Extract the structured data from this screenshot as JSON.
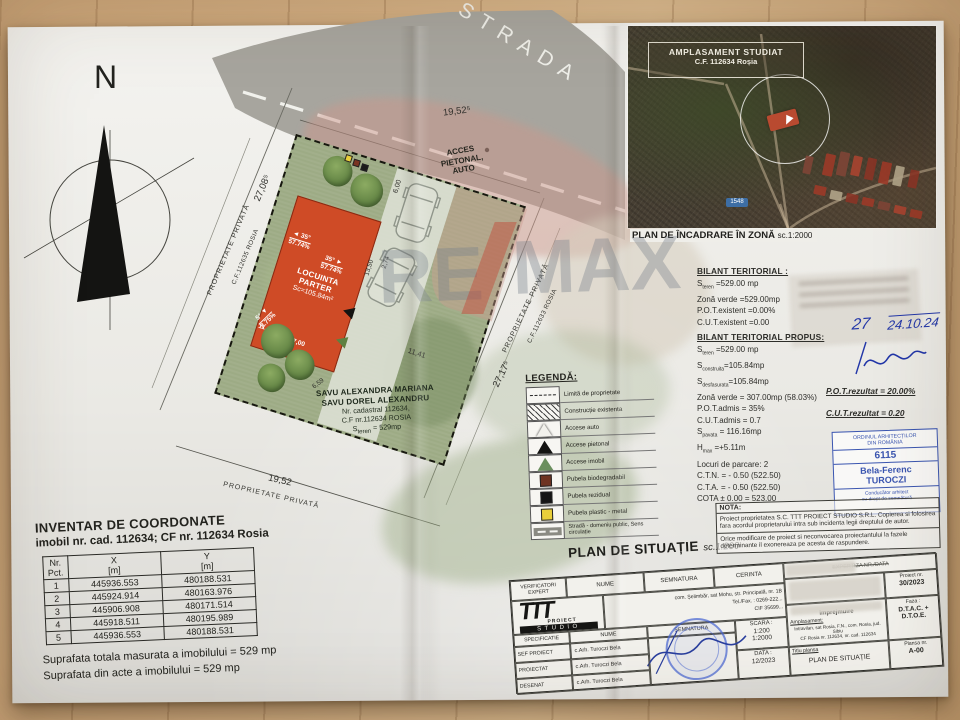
{
  "compass": {
    "label": "N"
  },
  "street": {
    "name": "STRADA",
    "dim": "19,52⁵",
    "access": [
      "ACCES",
      "PIETONAL,",
      "AUTO"
    ]
  },
  "parcel": {
    "owner": [
      "SAVU ALEXANDRA MARIANA",
      "SAVU DOREL ALEXANDRU",
      "Nr. cadastral 112634,",
      "C.F nr.112634 ROSIA",
      "S~teren~ = 529mp"
    ],
    "building": {
      "lines": [
        "LOCUINTA",
        "PARTER",
        "Sc=105.84m²"
      ],
      "slopes": [
        {
          "deg": "35°",
          "pct": "57.74%"
        },
        {
          "deg": "35°",
          "pct": "57.74%"
        },
        {
          "deg": "5°",
          "pct": "8.75%"
        }
      ]
    },
    "dims": {
      "bottom": "19,52",
      "left": "27,08⁵",
      "right": "27,17⁵",
      "drive_width": "6,00",
      "drive_length": "11,41",
      "bld_width": "7,00",
      "bld_side": "11,11",
      "bld_length": "13,50",
      "drive_offset": "2,74",
      "garden_side": "6,59"
    },
    "neighbors": {
      "left1": "PROPRIETATE PRIVATĂ",
      "left2": "C.F.112635 ROSIA",
      "right1": "PROPRIETATE PRIVATĂ",
      "right2": "C.F.112633 ROSIA",
      "bottom": "PROPRIETATE PRIVATĂ"
    }
  },
  "inset": {
    "label1": "AMPLASAMENT STUDIAT",
    "label2": "C.F. 112634 Roșia",
    "road_badge": "1548",
    "caption": "PLAN DE ÎNCADRARE ÎN ZONĂ",
    "caption_scale": "sc.1:2000"
  },
  "bilant": {
    "title_existent": "BILANT TERITORIAL :",
    "existent": [
      "S~teren~ =529.00 mp",
      "Zonă verde =529.00mp",
      "P.O.T.existent =0.00%",
      "C.U.T.existent =0.00"
    ],
    "title_propus": "BILANT TERITORIAL PROPUS:",
    "propus": [
      "S~teren~ =529.00 mp",
      "S~construita~=105.84mp",
      "S~desfasurata~=105.84mp",
      "Zonă verde = 307.00mp (58.03%)",
      "P.O.T.admis = 35%",
      "C.U.T.admis = 0.7",
      "S~pavata~ = 116.16mp",
      "H~max~ =+5.11m",
      "Locuri de parcare: 2",
      "C.T.N. = - 0.50 (522.50)",
      "C.T.A. = - 0.50 (522.50)",
      "COTA ± 0.00 = 523.00"
    ],
    "rezultat_pot": "P.O.T.rezultat = 20.00%",
    "rezultat_cut": "C.U.T.rezultat = 0.20"
  },
  "handwriting": {
    "number": "27",
    "date": "24.10.24"
  },
  "oar_stamp": {
    "line1": "ORDINUL ARHITECȚILOR",
    "line2": "DIN ROMÂNIA",
    "number": "6115",
    "name1": "Bela-Ferenc",
    "name2": "TUROCZI",
    "line3": "Conducător arhitect",
    "line4": "cu drept de semnătură"
  },
  "legend": {
    "title": "LEGENDĂ:",
    "items": [
      {
        "sym": "limit",
        "label": "Limită de proprietate"
      },
      {
        "sym": "hatch",
        "label": "Construcție existenta"
      },
      {
        "sym": "tri-white",
        "label": "Accese auto"
      },
      {
        "sym": "tri-black",
        "label": "Accese pietonal"
      },
      {
        "sym": "tri-green",
        "label": "Accese imobil"
      },
      {
        "sym": "sq-brown",
        "label": "Pubela biodegradabil"
      },
      {
        "sym": "sq-black",
        "label": "Pubela rezidual"
      },
      {
        "sym": "sq-yellow",
        "label": "Pubela plastic - metal"
      },
      {
        "sym": "road",
        "label": "Stradă - domeniu public, Sens circulație"
      }
    ]
  },
  "plan_title": {
    "text": "PLAN DE SITUAȚIE",
    "scale": "sc.1:200"
  },
  "inventar": {
    "title": "INVENTAR DE COORDONATE",
    "subtitle": "imobil nr. cad. 112634; CF nr. 112634 Rosia",
    "col1": [
      "Nr.",
      "Pct."
    ],
    "col2": [
      "X",
      "[m]"
    ],
    "col3": [
      "Y",
      "[m]"
    ],
    "rows": [
      [
        "1",
        "445936.553",
        "480188.531"
      ],
      [
        "2",
        "445924.914",
        "480163.976"
      ],
      [
        "3",
        "445906.908",
        "480171.514"
      ],
      [
        "4",
        "445918.511",
        "480195.989"
      ],
      [
        "5",
        "445936.553",
        "480188.531"
      ]
    ],
    "note1": "Suprafata totala masurata a imobilului = 529 mp",
    "note2": "Suprafata din acte a imobilului = 529 mp"
  },
  "nota": {
    "title": "NOTA:",
    "p1": "Proiect proprietatea S.C. TTT PROIECT STUDIO S.R.L. Copierea si folosirea fara acordul proprietarului intra sub incidenta legii dreptului de autor.",
    "p2": "Orice modificare de proiect si neconvocarea proiectantului la fazele determinante il exonereaza pe acesta de raspundere."
  },
  "cartouche": {
    "verif": [
      "VERIFICATORI EXPERT",
      "NUME",
      "SEMNATURA",
      "CERINTA"
    ],
    "firm": {
      "logo_top": "TTT",
      "logo_mid": "PROIECT",
      "logo_bottom": "STUDIO",
      "addr1": "com. Șelimbăr, sat Mohu, str. Principală, nr. 1B",
      "addr2": "Tel./Fax. : 0269-222...",
      "addr3": "CIF 35699..."
    },
    "spec_header": [
      "SPECIFICATIE",
      "NUME",
      "SEMNATURA"
    ],
    "spec_rows": [
      [
        "SEF PROIECT",
        "c.Arh. Turoczi Bela"
      ],
      [
        "PROIECTAT",
        "c.Arh. Turoczi Bela"
      ],
      [
        "DESENAT",
        "c.Arh. Turoczi Bela"
      ]
    ],
    "scara_label": "SCARA :",
    "scara1": "1:200",
    "scara2": "1:2000",
    "data_label": "DATA :",
    "data_value": "12/2023",
    "expertiza": "EXPERTIZA NR./DATA",
    "proiect_label": "Proiect nr.",
    "proiect_nr": "30/2023",
    "denumire": "împrejmuire",
    "ampl_label": "Amplasament:",
    "ampl1": "Intravilan, sat Rosia, F.N., com. Rosia, jud. Sibiu",
    "ampl2": "CF Rosia nr. 112634, nr. cad. 112634",
    "faza_label": "Faza :",
    "faza1": "D.T.A.C. +",
    "faza2": "D.T.O.E.",
    "titlu_label": "Titlu plansa",
    "titlu": "PLAN DE SITUAȚIE",
    "plansa_label": "Plansa nr.",
    "plansa": "A-00"
  },
  "watermark": {
    "part1": "RE",
    "part2": "MAX"
  },
  "colors": {
    "plot_green": "#9dab85",
    "building_red": "#cf4b26",
    "stamp_blue": "#3a55b0",
    "road_gray": "#a7a59e"
  }
}
